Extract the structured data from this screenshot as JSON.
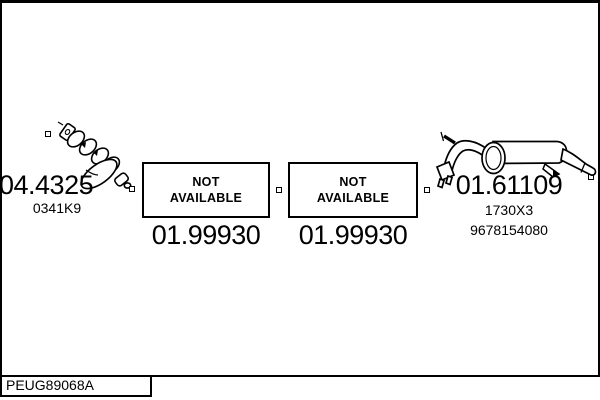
{
  "canvas": {
    "background_color": "#ffffff",
    "line_color": "#000000"
  },
  "parts": {
    "manifold": {
      "ref": "04.4325",
      "oe_code": "0341K9",
      "icon": "exhaust-manifold-drawing"
    },
    "front_section": {
      "status": {
        "line1": "NOT",
        "line2": "AVAILABLE"
      },
      "ref": "01.99930"
    },
    "middle_section": {
      "status": {
        "line1": "NOT",
        "line2": "AVAILABLE"
      },
      "ref": "01.99930"
    },
    "rear_silencer": {
      "ref": "01.61109",
      "oe_code": "1730X3",
      "oe_code2": "9678154080",
      "icon": "rear-silencer-drawing"
    }
  },
  "icons": {
    "marker": "connector-square-marker"
  },
  "footer": {
    "diagram_code": "PEUG89068A"
  }
}
